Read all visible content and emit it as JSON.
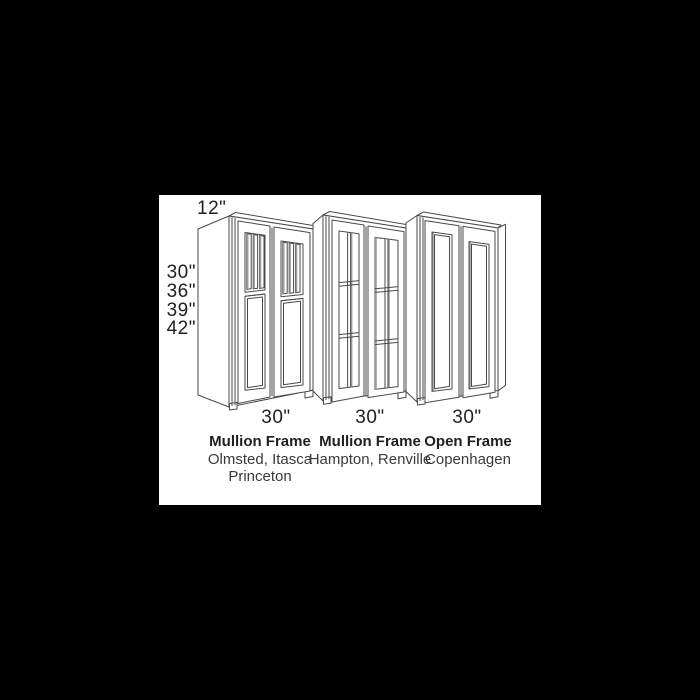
{
  "window": {
    "background_color": "#000000",
    "panel_color": "#ffffff"
  },
  "diagram": {
    "title": "wall-cabinet-size-and-frame-style-diagram",
    "depth_label": "12\"",
    "height_labels": [
      "30\"",
      "36\"",
      "39\"",
      "42\""
    ],
    "columns": [
      {
        "width_label": "30\"",
        "frame_type": "Mullion Frame",
        "style_names": [
          "Olmsted, Itasca",
          "Princeton"
        ]
      },
      {
        "width_label": "30\"",
        "frame_type": "Mullion Frame",
        "style_names": [
          "Hampton, Renville"
        ]
      },
      {
        "width_label": "30\"",
        "frame_type": "Open Frame",
        "style_names": [
          "Copenhagen"
        ]
      }
    ],
    "colors": {
      "line": "#4a4a4a",
      "shade": "#9e9e9e",
      "text": "#1f1f1f"
    }
  }
}
